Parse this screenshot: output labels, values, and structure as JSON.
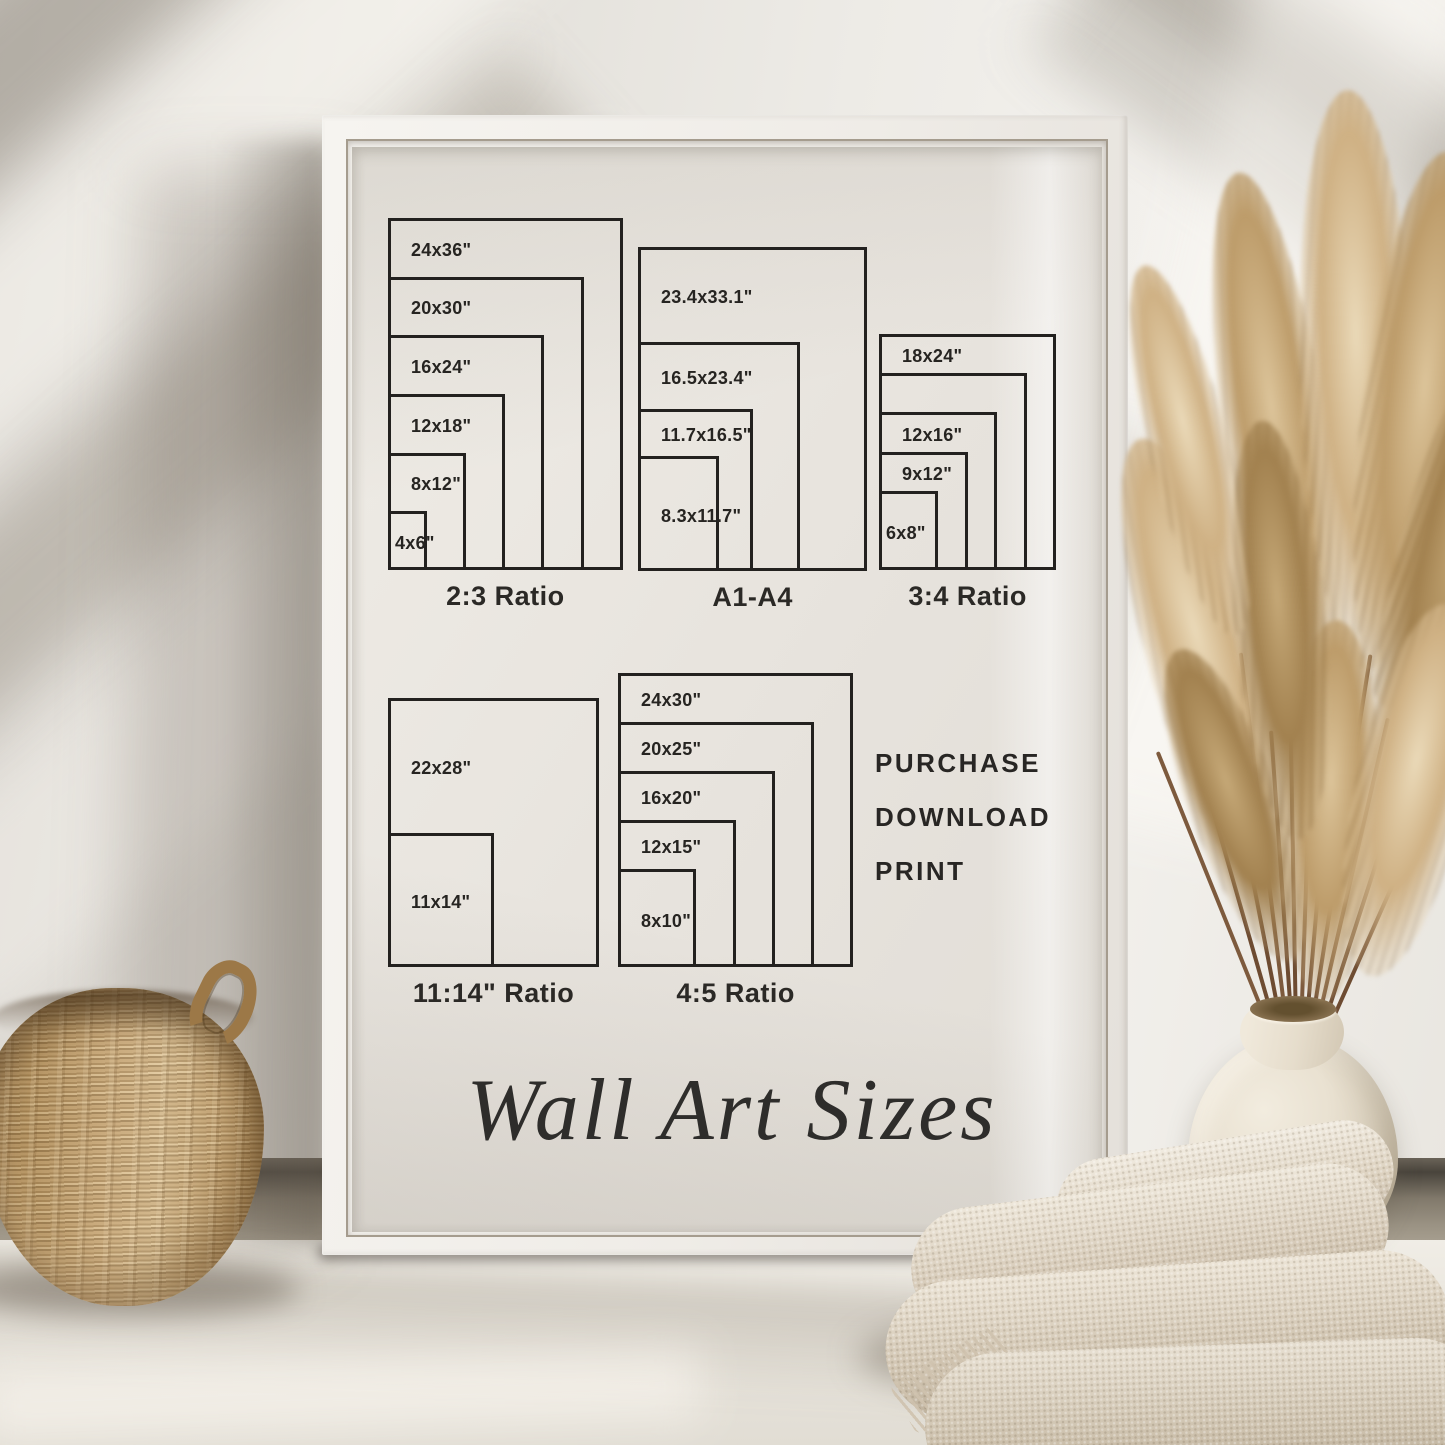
{
  "poster": {
    "size_groups": [
      {
        "title": "2:3 Ratio",
        "sizes": [
          {
            "label": "24x36\"",
            "w": 24,
            "h": 36
          },
          {
            "label": "20x30\"",
            "w": 20,
            "h": 30
          },
          {
            "label": "16x24\"",
            "w": 16,
            "h": 24
          },
          {
            "label": "12x18\"",
            "w": 12,
            "h": 18
          },
          {
            "label": "8x12\"",
            "w": 8,
            "h": 12
          },
          {
            "label": "4x6\"",
            "w": 4,
            "h": 6
          }
        ]
      },
      {
        "title": "A1-A4",
        "sizes": [
          {
            "label": "23.4x33.1\"",
            "w": 23.4,
            "h": 33.1
          },
          {
            "label": "16.5x23.4\"",
            "w": 16.5,
            "h": 23.4
          },
          {
            "label": "11.7x16.5\"",
            "w": 11.7,
            "h": 16.5
          },
          {
            "label": "8.3x11.7\"",
            "w": 8.3,
            "h": 11.7
          }
        ]
      },
      {
        "title": "3:4 Ratio",
        "sizes": [
          {
            "label": "18x24\"",
            "w": 18,
            "h": 24
          },
          {
            "label": "",
            "w": 15,
            "h": 20
          },
          {
            "label": "12x16\"",
            "w": 12,
            "h": 16
          },
          {
            "label": "9x12\"",
            "w": 9,
            "h": 12
          },
          {
            "label": "6x8\"",
            "w": 6,
            "h": 8
          }
        ]
      },
      {
        "title": "11:14\" Ratio",
        "sizes": [
          {
            "label": "22x28\"",
            "w": 22,
            "h": 28
          },
          {
            "label": "11x14\"",
            "w": 11,
            "h": 14
          }
        ]
      },
      {
        "title": "4:5 Ratio",
        "sizes": [
          {
            "label": "24x30\"",
            "w": 24,
            "h": 30
          },
          {
            "label": "20x25\"",
            "w": 20,
            "h": 25
          },
          {
            "label": "16x20\"",
            "w": 16,
            "h": 20
          },
          {
            "label": "12x15\"",
            "w": 12,
            "h": 15
          },
          {
            "label": "8x10\"",
            "w": 8,
            "h": 10
          }
        ]
      }
    ],
    "actions": [
      "PURCHASE",
      "DOWNLOAD",
      "PRINT"
    ],
    "script_title": "Wall Art Sizes"
  },
  "colors": {
    "wall": "#e7e4de",
    "frame": "#f3f1ed",
    "poster_paper": "#e9e6e0",
    "diagram_line": "#23211f",
    "text": "#262421",
    "basket_tan": "#c9a878",
    "pampas_tan": "#c3a477",
    "vase_cream": "#e9e1d1",
    "blanket_cream": "#e3dccd",
    "floor": "#eae7e0",
    "baseboard": "#4e483f"
  }
}
